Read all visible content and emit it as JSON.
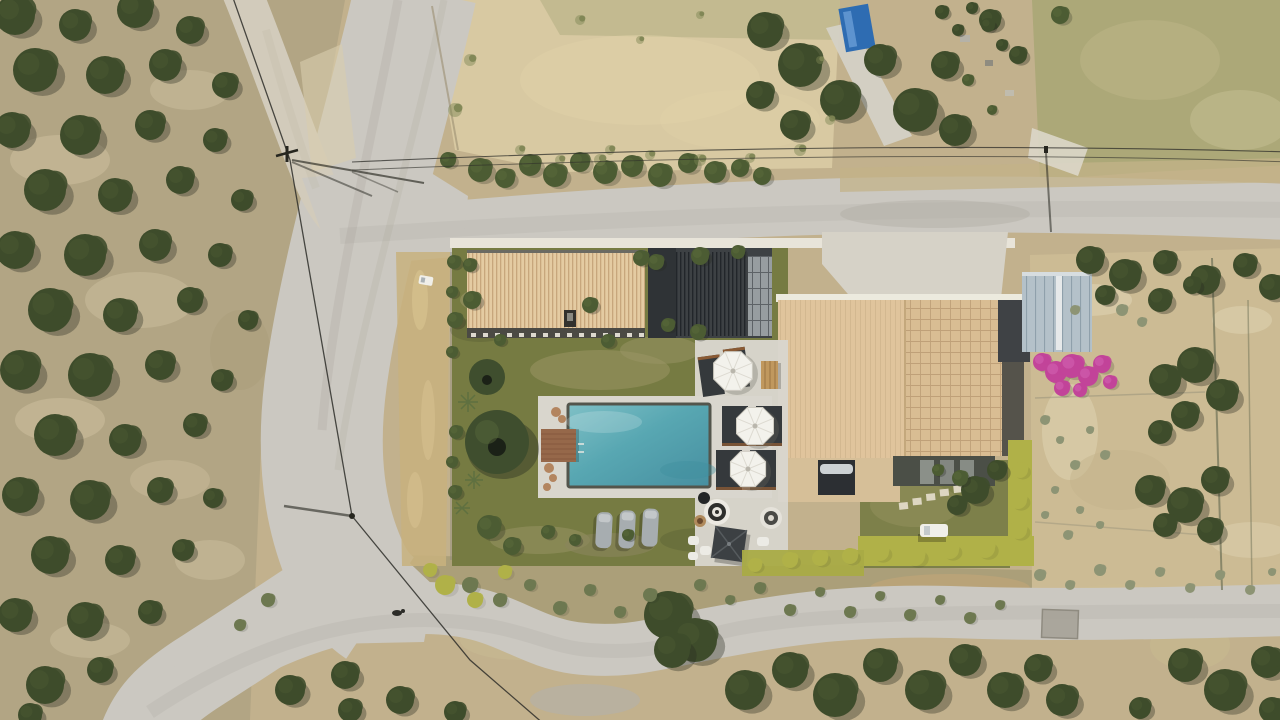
{
  "canvas": {
    "width": 1280,
    "height": 720
  },
  "scene": {
    "kind": "aerial-drone-photograph",
    "subject": "villa-with-pool-among-olive-groves"
  },
  "palette": {
    "soil": "#c2b18d",
    "grove_soil": "#b2a584",
    "band_soil": "#ab9f79",
    "field_straw": "#d8c9a2",
    "field_green_band": "#b6b183",
    "field_scrub": "#aca878",
    "garden_soil": "#ccbb94",
    "road": "#cbc8c1",
    "road_dirt": "#d2cbbb",
    "tree_dark": "#3e4c2b",
    "tree_mid": "#4c5c33",
    "tree_light": "#5d6d3c",
    "sage": "#8d9474",
    "scrub_olive": "#6d7850",
    "weed_green": "#7d8453",
    "shadow": "#272c20",
    "lawn": "#767b42",
    "lawn_dry": "#9a9565",
    "terrace": "#d9d6cd",
    "pool_light": "#7fc0c6",
    "pool_mid": "#58a7b2",
    "pool_deep": "#478fa0",
    "pool_coping": "#53554c",
    "deck_wood": "#96684a",
    "guesthouse_roof": "#e4cba2",
    "roof_eave_dark": "#4b4a44",
    "pergola_dark": "#3d4144",
    "pergola_panel": "#979da0",
    "house_roof_plain": "#e0c49c",
    "house_roof_tile": "#d9bd93",
    "house_fascia": "#55534b",
    "flat_roof_dark": "#4b4f47",
    "solar_panel": "#2c2f33",
    "solar_tank": "#ccd1d4",
    "umbrella_white": "#f3f2ec",
    "mat_dark": "#35393c",
    "lounger": "#a7adb0",
    "hedge_yellow": "#b0b148",
    "bougainvillea": "#c24499",
    "bougainvillea_light": "#d86ab8",
    "greenhouse": "#b4c1c9",
    "wire": "#2e2e29",
    "car_white": "#f0efe9",
    "concrete_pad": "#d6d2c7",
    "wall_white": "#e8e4d9"
  },
  "features": {
    "pool_count": 1,
    "white_umbrella_count": 3,
    "square_umbrella_count": 1,
    "sun_lounger_count": 3,
    "building_count": 3
  },
  "vegetation": {
    "olive_trees": [
      [
        15,
        15,
        20
      ],
      [
        75,
        25,
        16
      ],
      [
        135,
        10,
        18
      ],
      [
        190,
        30,
        14
      ],
      [
        35,
        70,
        22
      ],
      [
        105,
        75,
        19
      ],
      [
        165,
        65,
        16
      ],
      [
        225,
        85,
        13
      ],
      [
        12,
        130,
        18
      ],
      [
        80,
        135,
        20
      ],
      [
        150,
        125,
        15
      ],
      [
        215,
        140,
        12
      ],
      [
        45,
        190,
        21
      ],
      [
        115,
        195,
        17
      ],
      [
        180,
        180,
        14
      ],
      [
        242,
        200,
        11
      ],
      [
        15,
        250,
        19
      ],
      [
        85,
        255,
        21
      ],
      [
        155,
        245,
        16
      ],
      [
        220,
        255,
        12
      ],
      [
        50,
        310,
        22
      ],
      [
        120,
        315,
        17
      ],
      [
        190,
        300,
        13
      ],
      [
        248,
        320,
        10
      ],
      [
        20,
        370,
        20
      ],
      [
        90,
        375,
        22
      ],
      [
        160,
        365,
        15
      ],
      [
        222,
        380,
        11
      ],
      [
        55,
        435,
        21
      ],
      [
        125,
        440,
        16
      ],
      [
        195,
        425,
        12
      ],
      [
        20,
        495,
        18
      ],
      [
        90,
        500,
        20
      ],
      [
        160,
        490,
        13
      ],
      [
        213,
        498,
        10
      ],
      [
        50,
        555,
        19
      ],
      [
        120,
        560,
        15
      ],
      [
        183,
        550,
        11
      ],
      [
        15,
        615,
        17
      ],
      [
        85,
        620,
        18
      ],
      [
        150,
        612,
        12
      ],
      [
        45,
        685,
        19
      ],
      [
        100,
        670,
        13
      ],
      [
        30,
        715,
        12
      ],
      [
        290,
        690,
        15
      ],
      [
        345,
        675,
        14
      ],
      [
        400,
        700,
        14
      ],
      [
        455,
        712,
        11
      ],
      [
        350,
        710,
        12
      ],
      [
        668,
        615,
        24
      ],
      [
        695,
        640,
        22
      ],
      [
        672,
        650,
        18
      ],
      [
        745,
        690,
        20
      ],
      [
        790,
        670,
        18
      ],
      [
        835,
        695,
        22
      ],
      [
        880,
        665,
        17
      ],
      [
        925,
        690,
        20
      ],
      [
        965,
        660,
        16
      ],
      [
        1005,
        690,
        18
      ],
      [
        1038,
        668,
        14
      ],
      [
        1062,
        700,
        16
      ],
      [
        1185,
        665,
        17
      ],
      [
        1225,
        690,
        21
      ],
      [
        1267,
        662,
        16
      ],
      [
        1272,
        710,
        13
      ],
      [
        1140,
        708,
        11
      ],
      [
        765,
        30,
        18
      ],
      [
        800,
        65,
        22
      ],
      [
        840,
        100,
        20
      ],
      [
        880,
        60,
        16
      ],
      [
        915,
        110,
        22
      ],
      [
        945,
        65,
        14
      ],
      [
        955,
        130,
        16
      ],
      [
        795,
        125,
        15
      ],
      [
        760,
        95,
        14
      ],
      [
        990,
        20,
        11
      ],
      [
        1018,
        55,
        9
      ],
      [
        1090,
        260,
        14
      ],
      [
        1125,
        275,
        16
      ],
      [
        1165,
        262,
        12
      ],
      [
        1205,
        280,
        15
      ],
      [
        1245,
        265,
        12
      ],
      [
        1272,
        287,
        13
      ],
      [
        1105,
        295,
        10
      ],
      [
        1160,
        300,
        12
      ],
      [
        1192,
        285,
        9
      ],
      [
        1165,
        380,
        16
      ],
      [
        1195,
        365,
        18
      ],
      [
        1222,
        395,
        16
      ],
      [
        1185,
        415,
        14
      ],
      [
        1160,
        432,
        12
      ],
      [
        1150,
        490,
        15
      ],
      [
        1185,
        505,
        18
      ],
      [
        1215,
        480,
        14
      ],
      [
        1165,
        525,
        12
      ],
      [
        1210,
        530,
        13
      ],
      [
        975,
        490,
        14
      ],
      [
        997,
        470,
        10
      ],
      [
        957,
        505,
        10
      ],
      [
        942,
        12,
        7
      ],
      [
        958,
        30,
        6
      ],
      [
        972,
        8,
        6
      ],
      [
        988,
        25,
        7
      ],
      [
        1002,
        45,
        6
      ]
    ],
    "bright_shrubs": [
      [
        480,
        170,
        12
      ],
      [
        505,
        178,
        10
      ],
      [
        530,
        165,
        11
      ],
      [
        555,
        175,
        12
      ],
      [
        580,
        162,
        10
      ],
      [
        605,
        172,
        12
      ],
      [
        632,
        166,
        11
      ],
      [
        660,
        175,
        12
      ],
      [
        688,
        163,
        10
      ],
      [
        715,
        172,
        11
      ],
      [
        740,
        168,
        9
      ],
      [
        762,
        176,
        9
      ],
      [
        968,
        80,
        6
      ],
      [
        992,
        110,
        5
      ],
      [
        1060,
        15,
        9
      ],
      [
        448,
        160,
        8
      ]
    ],
    "compound_plants": [
      [
        472,
        300,
        9
      ],
      [
        470,
        265,
        7
      ],
      [
        590,
        305,
        8
      ],
      [
        641,
        258,
        8
      ],
      [
        500,
        340,
        6
      ],
      [
        608,
        341,
        7
      ],
      [
        656,
        262,
        8
      ],
      [
        700,
        256,
        9
      ],
      [
        668,
        325,
        7
      ],
      [
        698,
        332,
        8
      ],
      [
        738,
        252,
        7
      ],
      [
        454,
        262,
        7
      ],
      [
        452,
        292,
        6
      ],
      [
        455,
        320,
        8
      ],
      [
        452,
        352,
        6
      ],
      [
        456,
        432,
        7
      ],
      [
        452,
        462,
        6
      ],
      [
        455,
        492,
        7
      ],
      [
        489,
        527,
        12
      ],
      [
        512,
        546,
        9
      ],
      [
        548,
        532,
        7
      ],
      [
        575,
        540,
        6
      ],
      [
        628,
        535,
        6
      ],
      [
        960,
        478,
        8
      ],
      [
        938,
        470,
        6
      ]
    ],
    "sage_dots": [
      [
        1045,
        420,
        5
      ],
      [
        1060,
        440,
        4
      ],
      [
        1075,
        465,
        5
      ],
      [
        1055,
        490,
        4
      ],
      [
        1090,
        430,
        4
      ],
      [
        1105,
        455,
        5
      ],
      [
        1045,
        515,
        4
      ],
      [
        1080,
        510,
        4
      ],
      [
        1068,
        535,
        5
      ],
      [
        1100,
        525,
        4
      ],
      [
        1040,
        575,
        6
      ],
      [
        1070,
        585,
        5
      ],
      [
        1100,
        570,
        6
      ],
      [
        1130,
        585,
        5
      ],
      [
        1160,
        572,
        5
      ],
      [
        1190,
        588,
        5
      ],
      [
        1220,
        575,
        5
      ],
      [
        1250,
        590,
        5
      ],
      [
        1272,
        572,
        4
      ],
      [
        1122,
        310,
        6
      ],
      [
        1142,
        322,
        5
      ],
      [
        1075,
        310,
        5
      ]
    ],
    "scrub_bushes": [
      [
        470,
        585,
        8
      ],
      [
        500,
        600,
        7
      ],
      [
        530,
        585,
        6
      ],
      [
        560,
        608,
        7
      ],
      [
        590,
        590,
        6
      ],
      [
        620,
        612,
        6
      ],
      [
        650,
        595,
        7
      ],
      [
        700,
        585,
        6
      ],
      [
        730,
        600,
        5
      ],
      [
        760,
        588,
        6
      ],
      [
        790,
        610,
        6
      ],
      [
        820,
        592,
        5
      ],
      [
        850,
        612,
        6
      ],
      [
        880,
        596,
        5
      ],
      [
        910,
        615,
        6
      ],
      [
        940,
        600,
        5
      ],
      [
        970,
        618,
        6
      ],
      [
        1000,
        605,
        5
      ],
      [
        268,
        600,
        7
      ],
      [
        240,
        625,
        6
      ]
    ],
    "yellow_bushes": [
      [
        445,
        585,
        10
      ],
      [
        475,
        600,
        8
      ],
      [
        505,
        572,
        7
      ],
      [
        430,
        570,
        7
      ],
      [
        880,
        552,
        9
      ],
      [
        915,
        556,
        10
      ],
      [
        950,
        550,
        9
      ],
      [
        985,
        548,
        10
      ],
      [
        1018,
        500,
        9
      ],
      [
        1020,
        470,
        8
      ],
      [
        1018,
        530,
        9
      ],
      [
        790,
        560,
        8
      ],
      [
        820,
        558,
        8
      ],
      [
        850,
        556,
        8
      ],
      [
        755,
        565,
        7
      ]
    ],
    "field_weeds": [
      [
        470,
        60,
        6
      ],
      [
        455,
        110,
        7
      ],
      [
        520,
        150,
        5
      ],
      [
        600,
        160,
        6
      ],
      [
        650,
        155,
        5
      ],
      [
        700,
        160,
        6
      ],
      [
        750,
        158,
        5
      ],
      [
        800,
        150,
        6
      ],
      [
        830,
        120,
        5
      ],
      [
        820,
        60,
        4
      ],
      [
        640,
        40,
        4
      ],
      [
        580,
        20,
        5
      ],
      [
        700,
        15,
        4
      ],
      [
        610,
        150,
        5
      ],
      [
        560,
        160,
        5
      ]
    ],
    "bougainvillea_blobs": [
      [
        1042,
        362,
        9
      ],
      [
        1056,
        372,
        11
      ],
      [
        1072,
        366,
        12
      ],
      [
        1088,
        376,
        10
      ],
      [
        1102,
        364,
        9
      ],
      [
        1110,
        382,
        7
      ],
      [
        1062,
        388,
        8
      ],
      [
        1080,
        390,
        7
      ]
    ]
  },
  "pool_area": {
    "umbrellas": [
      [
        733,
        371,
        21
      ],
      [
        755,
        426,
        20
      ],
      [
        748,
        469,
        19
      ]
    ]
  }
}
